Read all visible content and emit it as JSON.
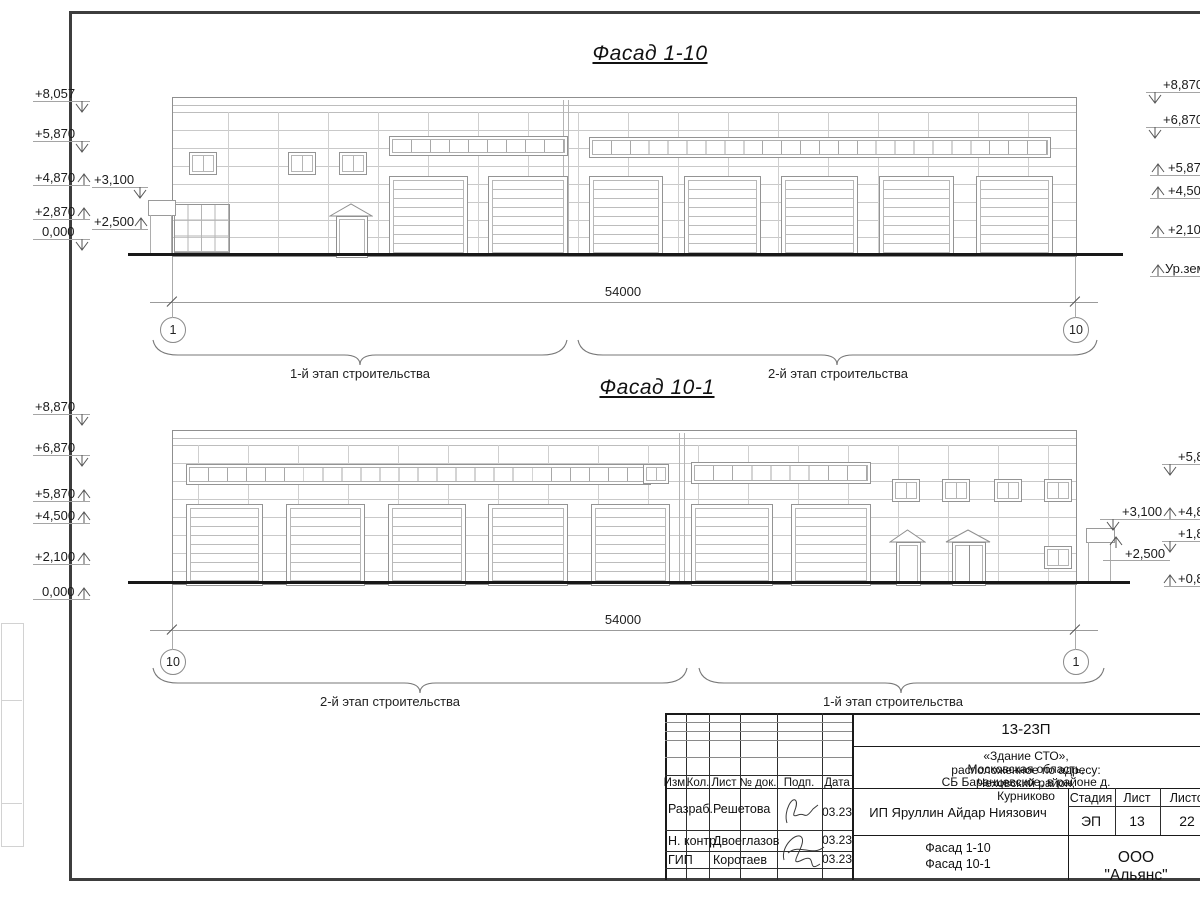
{
  "sheet": {
    "frame_color": "#3d3d3d",
    "line_color": "#c9c9c9",
    "ground_color": "#181818"
  },
  "top_facade": {
    "title": "Фасад 1-10",
    "dim_label": "54000",
    "grid_left": "1",
    "grid_right": "10",
    "stage_left_label": "1-й этап строительства",
    "stage_right_label": "2-й этап строительства",
    "left_marks": [
      "+8,057",
      "+5,870",
      "+4,870",
      "+3,100",
      "+2,870",
      "+2,500",
      "0,000"
    ],
    "right_marks": [
      "+8,870",
      "+6,870",
      "+5,870",
      "+4,500",
      "+2,100",
      "Ур.земли"
    ]
  },
  "bottom_facade": {
    "title": "Фасад 10-1",
    "dim_label": "54000",
    "grid_left": "10",
    "grid_right": "1",
    "stage_left_label": "2-й этап строительства",
    "stage_right_label": "1-й этап строительства",
    "left_marks": [
      "+8,870",
      "+6,870",
      "+5,870",
      "+4,500",
      "+2,100",
      "0,000"
    ],
    "inner_marks": [
      "+3,100",
      "+2,500"
    ],
    "right_marks": [
      "+5,8",
      "+4,8",
      "+1,8",
      "+0,8"
    ]
  },
  "title_block": {
    "doc_number": "13-23П",
    "address_line1": "«Здание СТО», расположенное по адресу:",
    "address_line2": "Московская область, Чеховский район,",
    "address_line3": "СБ Баранцевское, в районе д. Курниково",
    "col_izm": "Изм.",
    "col_kol": "Кол.",
    "col_list": "Лист",
    "col_doc": "№ док.",
    "col_podp": "Подп.",
    "col_data": "Дата",
    "row1_role": "Разраб.",
    "row1_name": "Решетова",
    "row1_date": "03.23",
    "row2_role": "Н. контр.",
    "row2_name": "Двоеглазов",
    "row2_date": "03.23",
    "row3_role": "ГИП",
    "row3_name": "Коротаев",
    "row3_date": "03.23",
    "client": "ИП Яруллин Айдар Ниязович",
    "stage_header": "Стадия",
    "sheet_header": "Лист",
    "sheets_header": "Листов",
    "stage": "ЭП",
    "sheet_no": "13",
    "sheets_total": "22",
    "drawing_title_line1": "Фасад 1-10",
    "drawing_title_line2": "Фасад 10-1",
    "company": "ООО \"Альянс\""
  }
}
